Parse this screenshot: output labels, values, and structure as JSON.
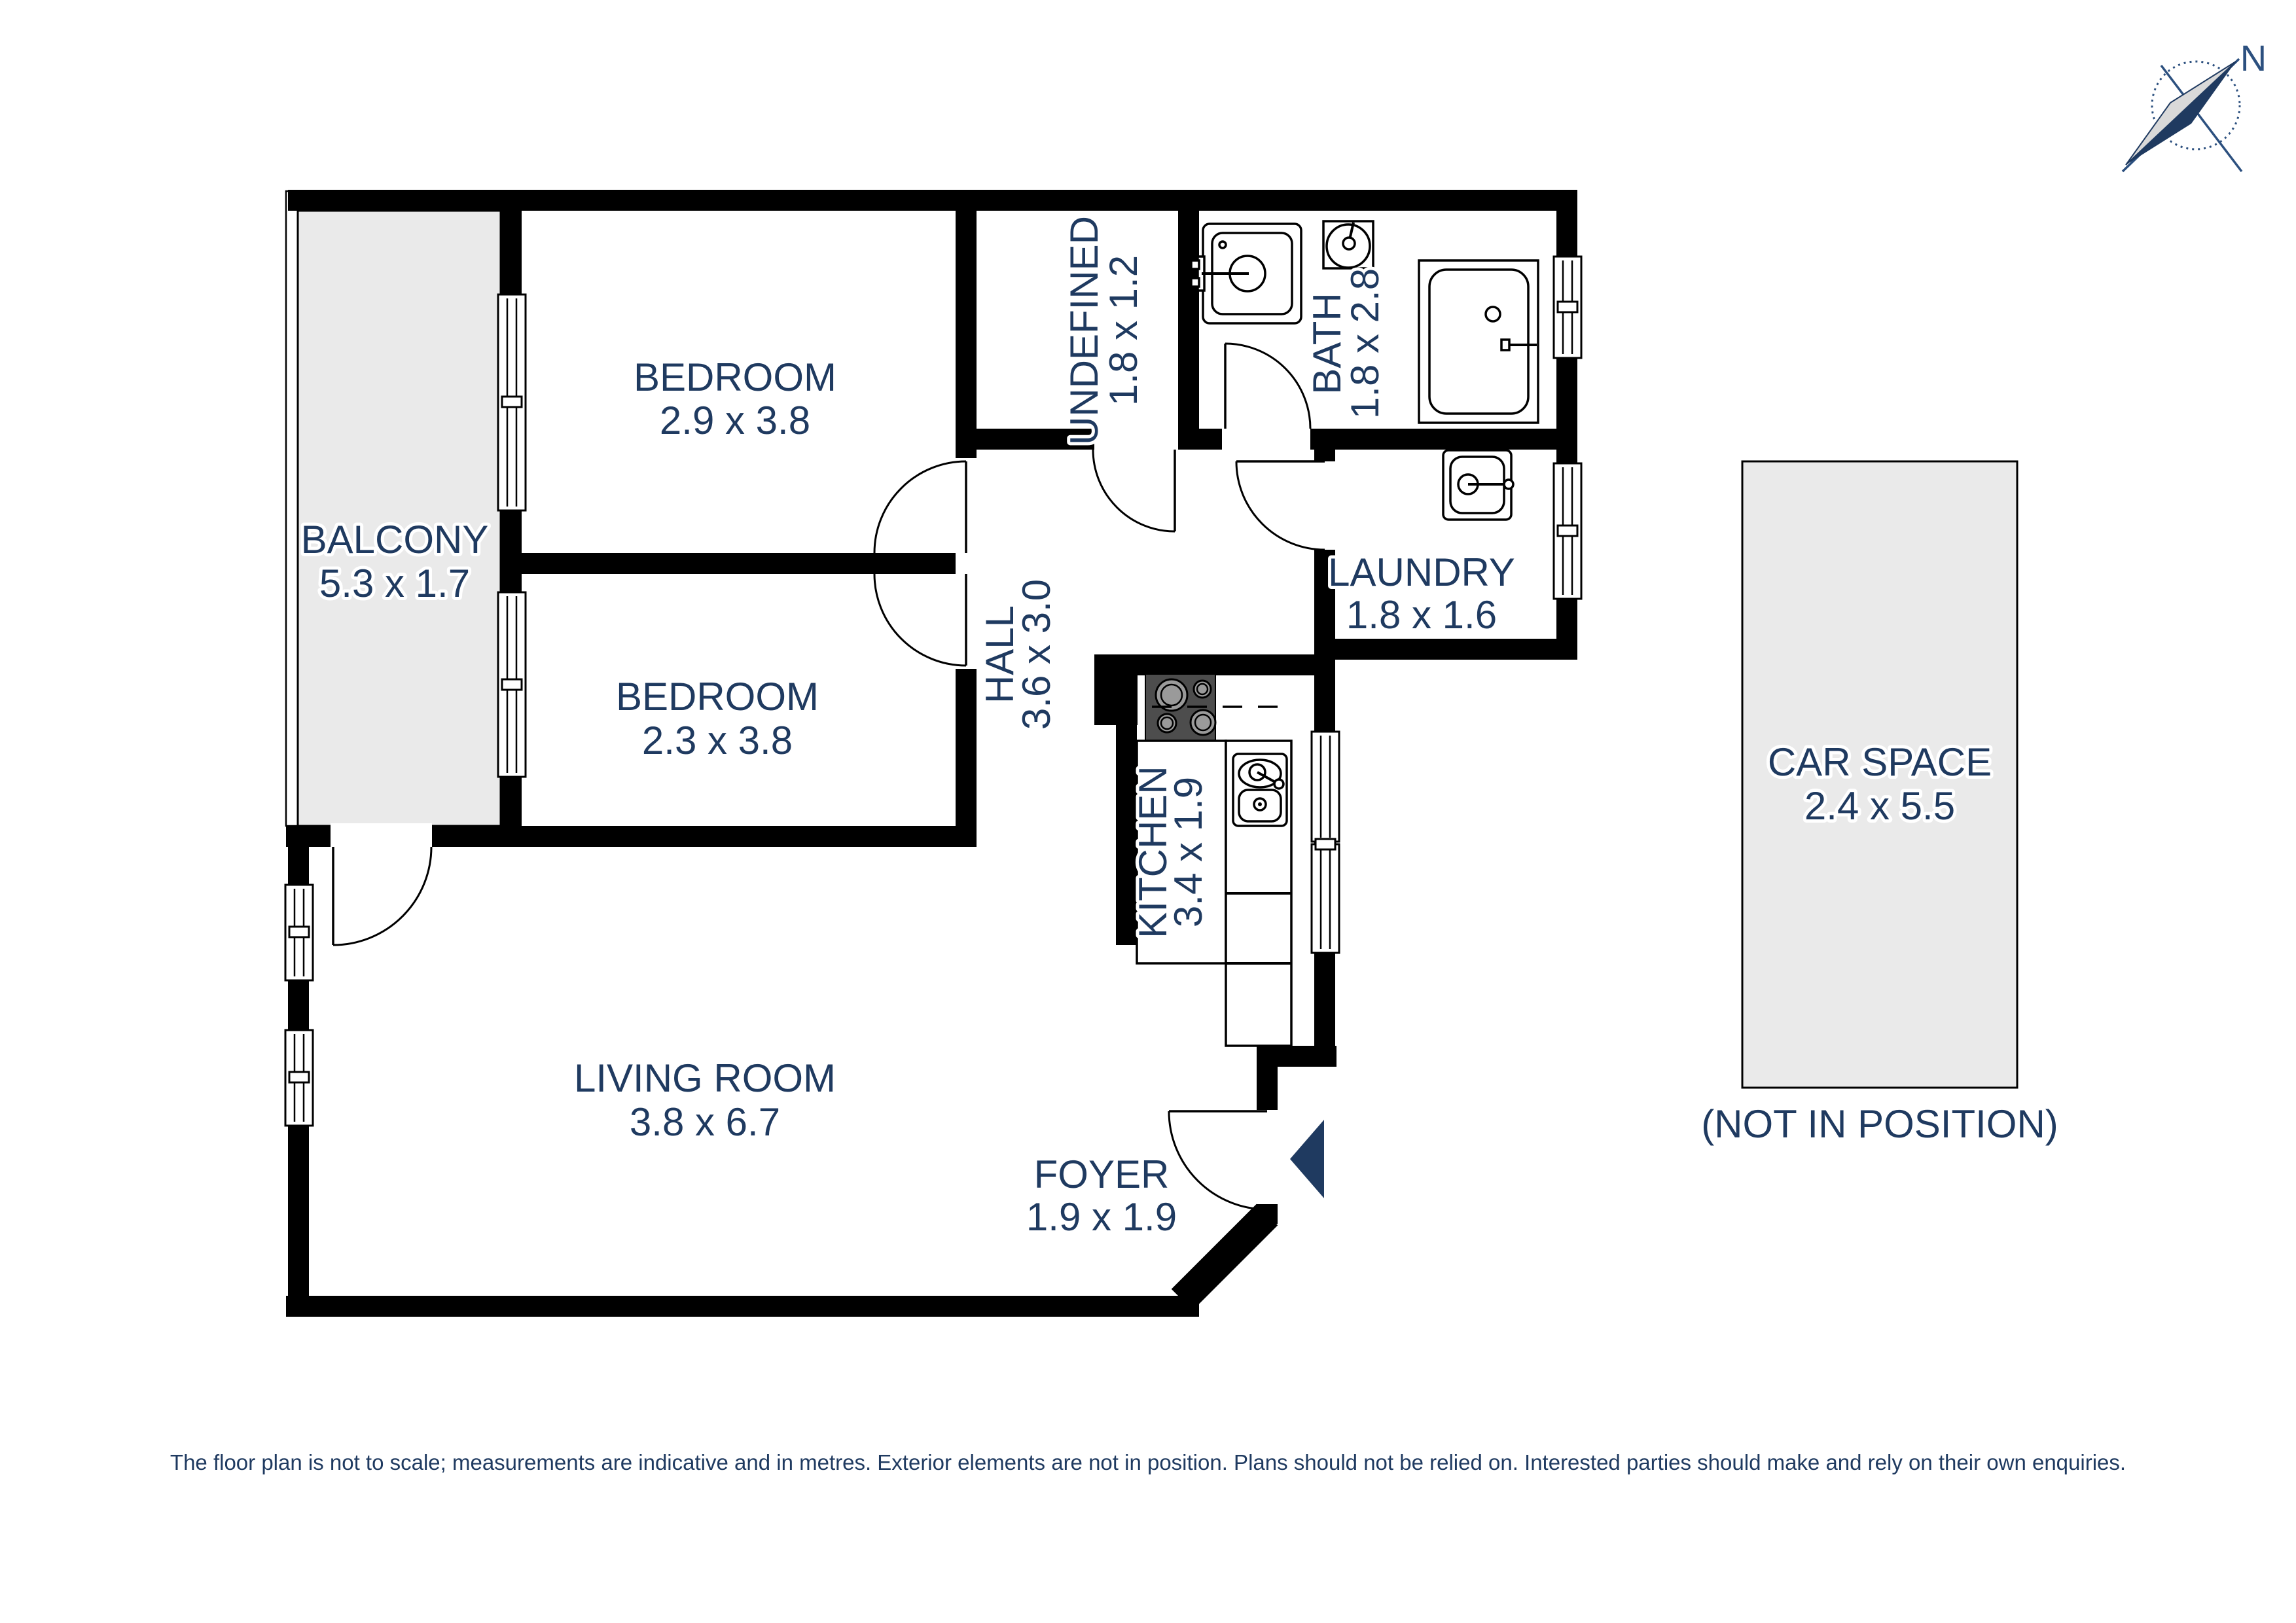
{
  "compass": {
    "north_label": "N"
  },
  "rooms": {
    "balcony": {
      "name": "BALCONY",
      "dims": "5.3 x 1.7"
    },
    "bedroom1": {
      "name": "BEDROOM",
      "dims": "2.9 x 3.8"
    },
    "bedroom2": {
      "name": "BEDROOM",
      "dims": "2.3 x 3.8"
    },
    "undefined_room": {
      "name": "UNDEFINED",
      "dims": "1.8 x 1.2"
    },
    "bath": {
      "name": "BATH",
      "dims": "1.8 x 2.8"
    },
    "laundry": {
      "name": "LAUNDRY",
      "dims": "1.8 x 1.6"
    },
    "hall": {
      "name": "HALL",
      "dims": "3.6 x 3.0"
    },
    "kitchen": {
      "name": "KITCHEN",
      "dims": "3.4 x 1.9"
    },
    "living_room": {
      "name": "LIVING ROOM",
      "dims": "3.8 x 6.7"
    },
    "foyer": {
      "name": "FOYER",
      "dims": "1.9 x 1.9"
    },
    "car_space": {
      "name": "CAR SPACE",
      "dims": "2.4 x 5.5",
      "note": "(NOT IN POSITION)"
    }
  },
  "footer": {
    "disclaimer": "The floor plan is not to scale; measurements are indicative and in metres. Exterior elements are not in position. Plans should not be relied on. Interested parties should make and rely on their own enquiries."
  },
  "colors": {
    "label": "#1f3a60",
    "wall": "#000000",
    "area_fill": "#eaeaea",
    "accent_navy": "#1f3a60"
  }
}
